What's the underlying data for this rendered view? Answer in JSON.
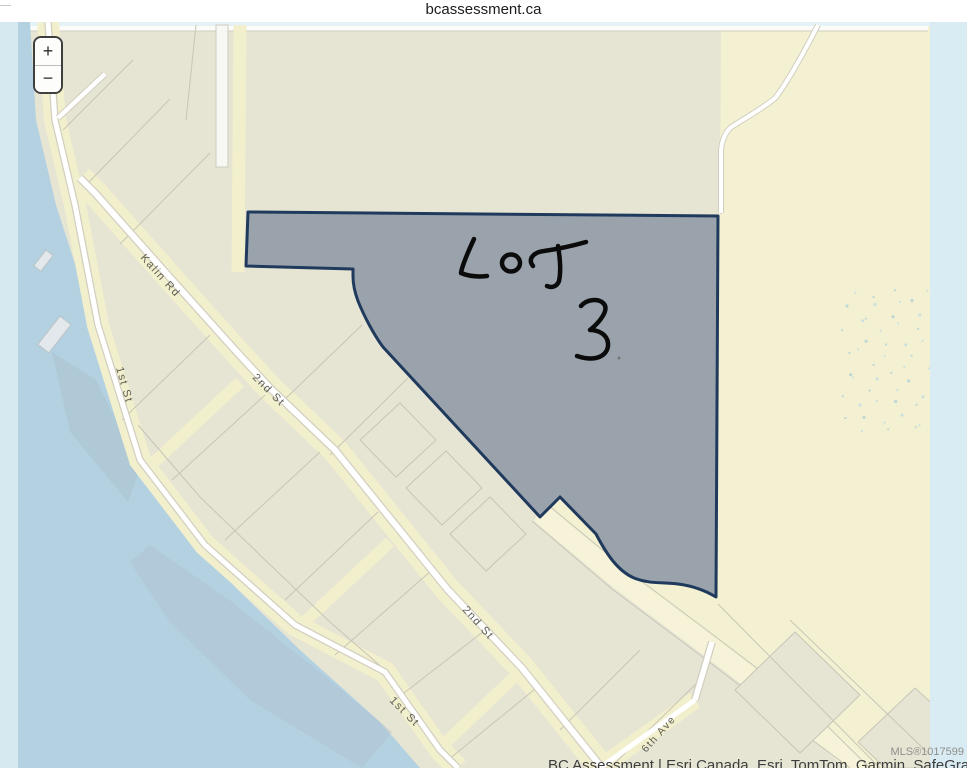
{
  "page": {
    "title": "bcassessment.ca"
  },
  "map": {
    "zoom_in_label": "+",
    "zoom_out_label": "−",
    "streets": [
      {
        "name": "Kalin Rd"
      },
      {
        "name": "1st St"
      },
      {
        "name": "2nd St"
      },
      {
        "name": "2nd St"
      },
      {
        "name": "1st St"
      },
      {
        "name": "6th Ave"
      }
    ],
    "lot": {
      "annotation": "LOT 3"
    },
    "mls_label": "MLS®1017599",
    "attribution": "BC Assessment | Esri Canada, Esri, TomTom, Garmin, SafeGraph, GeoTechnologies, Inc",
    "colors": {
      "lot_fill": "#9aa3ac",
      "lot_border": "#1f3a5c",
      "water": "#b3d1e1",
      "water_edge": "#d6e9f1",
      "land": "#e6e4d3",
      "road_yellow": "#f2efcd",
      "parcel_yellow": "#f4f1d3"
    }
  }
}
